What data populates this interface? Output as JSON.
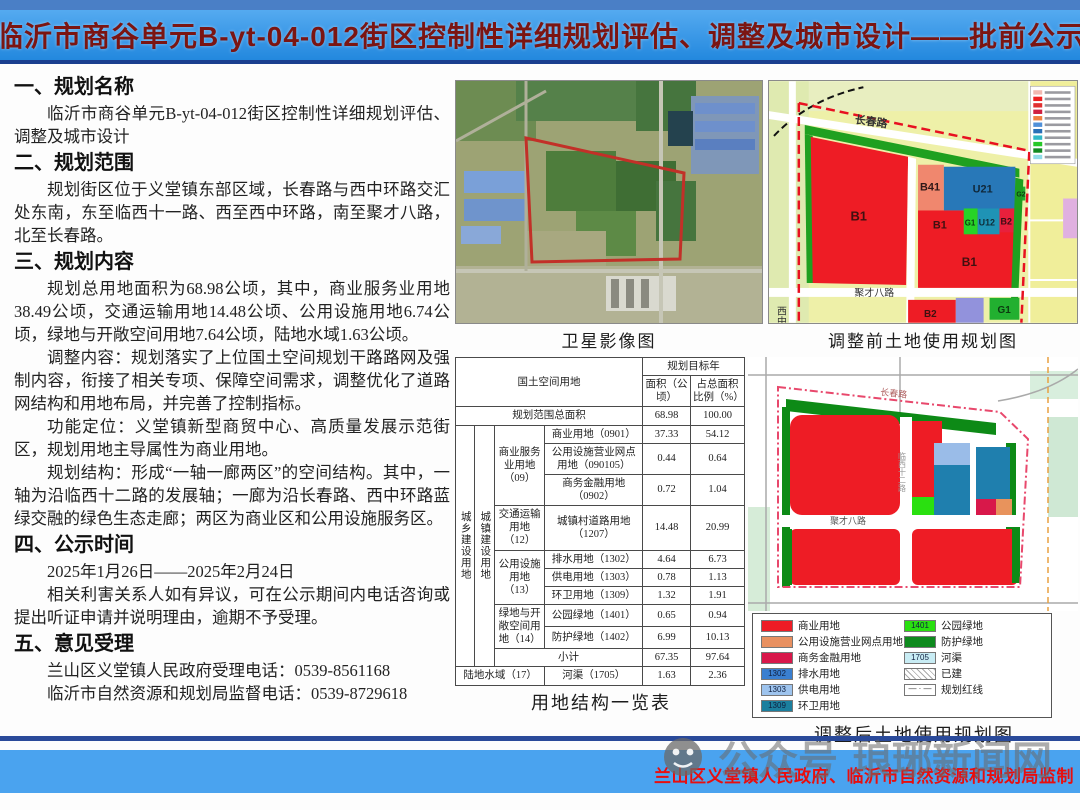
{
  "title": "临沂市商谷单元B-yt-04-012街区控制性详细规划评估、调整及城市设计——批前公示",
  "sections": [
    {
      "heading": "一、规划名称",
      "paragraphs": [
        "临沂市商谷单元B-yt-04-012街区控制性详细规划评估、调整及城市设计"
      ]
    },
    {
      "heading": "二、规划范围",
      "paragraphs": [
        "规划街区位于义堂镇东部区域，长春路与西中环路交汇处东南，东至临西十一路、西至西中环路，南至聚才八路，北至长春路。"
      ]
    },
    {
      "heading": "三、规划内容",
      "paragraphs": [
        "规划总用地面积为68.98公顷，其中，商业服务业用地38.49公顷，交通运输用地14.48公顷、公用设施用地6.74公顷，绿地与开敞空间用地7.64公顷，陆地水域1.63公顷。",
        "调整内容：规划落实了上位国土空间规划干路路网及强制内容，衔接了相关专项、保障空间需求，调整优化了道路网结构和用地布局，并完善了控制指标。",
        "功能定位：义堂镇新型商贸中心、高质量发展示范街区，规划用地主导属性为商业用地。",
        "规划结构：形成“一轴一廊两区”的空间结构。其中，一轴为沿临西十二路的发展轴；一廊为沿长春路、西中环路蓝绿交融的绿色生态走廊；两区为商业区和公用设施服务区。"
      ]
    },
    {
      "heading": "四、公示时间",
      "paragraphs": [
        "2025年1月26日——2025年2月24日",
        "相关利害关系人如有异议，可在公示期间内电话咨询或提出听证申请并说明理由，逾期不予受理。"
      ]
    },
    {
      "heading": "五、意见受理",
      "paragraphs": [
        "兰山区义堂镇人民政府受理电话：0539-8561168",
        "临沂市自然资源和规划局监督电话：0539-8729618"
      ]
    }
  ],
  "maps": {
    "satellite": {
      "caption": "卫星影像图"
    },
    "before": {
      "caption": "调整前土地使用规划图",
      "roads": {
        "top": "长春路",
        "bottom": "聚才八路",
        "left": "西中环路"
      },
      "labels": {
        "B1_left": "B1",
        "B41": "B41",
        "U21": "U21",
        "G2": "G2",
        "B1_mid": "B1",
        "G1_mid": "G1",
        "U12": "U12",
        "B2_mid": "B2",
        "B1_big": "B1",
        "B2_bottom": "B2",
        "G1_bottom": "G1"
      },
      "legend_colors": [
        "#f2b8b0",
        "#ee2020",
        "#e03030",
        "#d02040",
        "#f08040",
        "#5090d8",
        "#2870b8",
        "#30b8c8",
        "#28c828",
        "#108a20",
        "#90dce8"
      ]
    },
    "after": {
      "caption": "调整后土地使用规划图",
      "roads": {
        "top": "长春路",
        "mid": "聚才八路",
        "center": "临西十二路"
      }
    }
  },
  "table": {
    "caption": "用地结构一览表",
    "header": {
      "land": "国土空间用地",
      "year": "规划目标年",
      "area": "面积（公顷）",
      "pct": "占总面积比例（%）"
    },
    "total": {
      "label": "规划范围总面积",
      "area": "68.98",
      "pct": "100.00"
    },
    "v1": "城乡建设用地",
    "v2": "城镇建设用地",
    "g1": "商业服务业用地（09）",
    "g2": "交通运输用地（12）",
    "g3": "公用设施用地（13）",
    "g4": "绿地与开敞空间用地（14）",
    "rows": [
      {
        "label": "商业用地（0901）",
        "area": "37.33",
        "pct": "54.12"
      },
      {
        "label": "公用设施营业网点用地（090105）",
        "area": "0.44",
        "pct": "0.64"
      },
      {
        "label": "商务金融用地（0902）",
        "area": "0.72",
        "pct": "1.04"
      },
      {
        "label": "城镇村道路用地（1207）",
        "area": "14.48",
        "pct": "20.99"
      },
      {
        "label": "排水用地（1302）",
        "area": "4.64",
        "pct": "6.73"
      },
      {
        "label": "供电用地（1303）",
        "area": "0.78",
        "pct": "1.13"
      },
      {
        "label": "环卫用地（1309）",
        "area": "1.32",
        "pct": "1.91"
      },
      {
        "label": "公园绿地（1401）",
        "area": "0.65",
        "pct": "0.94"
      },
      {
        "label": "防护绿地（1402）",
        "area": "6.99",
        "pct": "10.13"
      }
    ],
    "subtotal": {
      "label": "小计",
      "area": "67.35",
      "pct": "97.64"
    },
    "water": {
      "label": "陆地水域（17）",
      "sub": "河渠（1705）",
      "area": "1.63",
      "pct": "2.36"
    }
  },
  "legend_after": {
    "left": [
      {
        "color": "#ee1c25",
        "label": "商业用地",
        "code": "",
        "type": "solid"
      },
      {
        "color": "#e89060",
        "label": "公用设施营业网点用地",
        "code": "",
        "type": "solid"
      },
      {
        "color": "#d8174a",
        "label": "商务金融用地",
        "code": "",
        "type": "solid"
      },
      {
        "color": "#3a7fd0",
        "label": "排水用地",
        "code": "1302",
        "type": "solid"
      },
      {
        "color": "#9ec4ee",
        "label": "供电用地",
        "code": "1303",
        "type": "solid"
      },
      {
        "color": "#1b7f9e",
        "label": "环卫用地",
        "code": "1309",
        "type": "solid"
      }
    ],
    "right": [
      {
        "color": "#2ae010",
        "label": "公园绿地",
        "code": "1401",
        "type": "solid"
      },
      {
        "color": "#0e8a1e",
        "label": "防护绿地",
        "code": "",
        "type": "solid"
      },
      {
        "color": "#c8ecf4",
        "label": "河渠",
        "code": "1705",
        "type": "solid"
      },
      {
        "color": "",
        "label": "已建",
        "code": "",
        "type": "hatch"
      },
      {
        "color": "",
        "label": "规划红线",
        "code": "",
        "type": "dashdot"
      }
    ]
  },
  "footer": {
    "credit": "兰山区义堂镇人民政府、临沂市自然资源和规划局监制",
    "watermark_label": "公众号",
    "watermark_name": "琅琊新闻网"
  },
  "colors": {
    "banner_blue": "#2e97e8",
    "banner_border": "#1b3f8f",
    "footer_blue": "#4aa3ef",
    "title_red": "#7b1512",
    "credit_red": "#e80e0e",
    "commercial_red": "#ee1c25",
    "utility_blue": "#1f7fae",
    "park_green": "#2ae010",
    "protect_green": "#0e8a1e",
    "boundary_red": "#e81020"
  }
}
